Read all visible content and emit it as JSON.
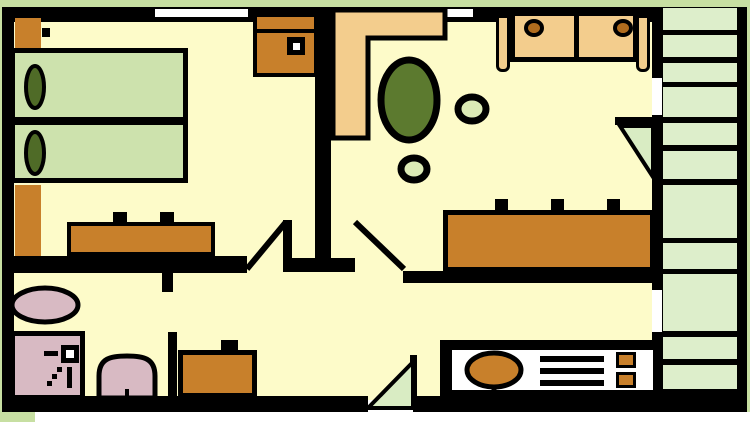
{
  "meta": {
    "type": "apartment-floor-plan",
    "width_px": 750,
    "height_px": 422,
    "text_labels": []
  },
  "colors": {
    "outer": "#c7dfa2",
    "wall": "#000000",
    "floor": "#fdfbc9",
    "bed": "#cde2ad",
    "pillow": "#4f6b27",
    "stairs": "#ddeecb",
    "door_swing": "#d9ecc3",
    "furniture": "#c8802b",
    "upholstery": "#f3cd8d",
    "accent_brown": "#b06c1e",
    "table": "#5c7a2f",
    "seat": "#dcebb6",
    "fixture": "#d8bac3",
    "counter": "#ffffff",
    "window": "#ffffff"
  },
  "rooms": [
    {
      "name": "bedroom",
      "position": "top-left"
    },
    {
      "name": "living-room",
      "position": "top-right"
    },
    {
      "name": "bathroom",
      "position": "bottom-left"
    },
    {
      "name": "hallway",
      "position": "bottom-middle"
    },
    {
      "name": "kitchen",
      "position": "bottom-right"
    },
    {
      "name": "staircase",
      "position": "right-edge"
    }
  ],
  "furniture": [
    "twin-bed-1",
    "twin-bed-2",
    "pillow-1",
    "pillow-2",
    "nightstand-top",
    "nightstand-bottom",
    "bedroom-dresser",
    "bedroom-cabinet-with-knob",
    "corner-wardrobe",
    "dining-table-oval",
    "stool-1",
    "stool-2",
    "two-seat-sofa",
    "sideboard",
    "bath-basin-oval",
    "shower-stall",
    "toilet",
    "hall-cabinet",
    "kitchen-counter",
    "kitchen-sink",
    "drainer-grill",
    "burner-1",
    "burner-2",
    "stair-treads"
  ],
  "openings": [
    "window-1-top-wall",
    "window-2-top-wall",
    "bedroom-door",
    "living-room-door",
    "stair-door-upper",
    "stair-door-lower",
    "entry-door-bottom"
  ]
}
